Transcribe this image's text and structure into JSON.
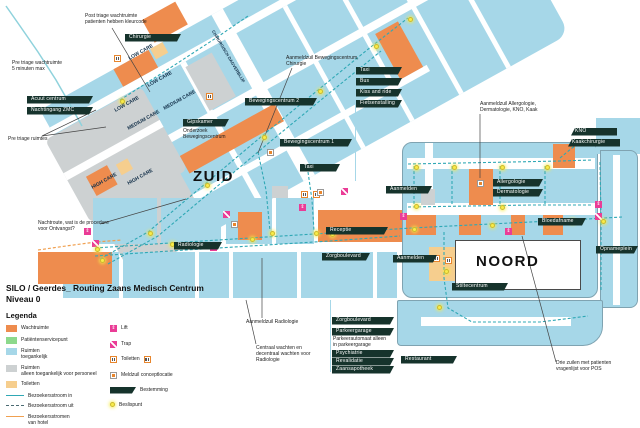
{
  "doc": {
    "title_line1": "SILO / Geerdes_ Routing Zaans Medisch Centrum",
    "title_line2": "Niveau 0",
    "legend_heading": "Legenda"
  },
  "colors": {
    "building_blue": "#A6D7E8",
    "waiting_orange": "#EE8C4E",
    "staff_gray": "#CDD1D2",
    "toilet_tan": "#F6CE8E",
    "service_green": "#8CD98C",
    "tag_dark": "#16332C",
    "route_teal": "#2FA8B5",
    "route_orange": "#F0A050",
    "decision_yellow": "#F7EC4A",
    "lift_pink": "#EA3C96"
  },
  "area_labels": [
    {
      "t": "ZUID",
      "x": 193,
      "y": 168,
      "s": 15,
      "big": true
    },
    {
      "t": "NOORD",
      "x": 476,
      "y": 253,
      "s": 15,
      "big": true
    },
    {
      "t": "LOW CARE",
      "x": 129,
      "y": 56,
      "r": -29
    },
    {
      "t": "LOW CARE",
      "x": 148,
      "y": 83,
      "r": -29
    },
    {
      "t": "LOW CARE",
      "x": 115,
      "y": 108,
      "r": -29
    },
    {
      "t": "MEDIUM CARE",
      "x": 164,
      "y": 106,
      "r": -29
    },
    {
      "t": "MEDIUM CARE",
      "x": 128,
      "y": 126,
      "r": -29
    },
    {
      "t": "HIGH CARE",
      "x": 92,
      "y": 185,
      "r": -29
    },
    {
      "t": "HIGH CARE",
      "x": 128,
      "y": 181,
      "r": -29
    },
    {
      "t": "CHIRURGISCH DAGVERBLIJF",
      "x": 213,
      "y": 28,
      "r": 59,
      "s": 4.2
    }
  ],
  "tags": [
    {
      "t": "Chirurgie",
      "x": 125,
      "y": 34,
      "w": 56
    },
    {
      "t": "Acuut centrum",
      "x": 27,
      "y": 96,
      "w": 66
    },
    {
      "t": "Nachtingang ZMC",
      "x": 27,
      "y": 107,
      "w": 66
    },
    {
      "t": "Gipskamer",
      "x": 183,
      "y": 119,
      "w": 46
    },
    {
      "t": "Bewegingscentrum 2",
      "x": 245,
      "y": 98,
      "w": 72
    },
    {
      "t": "Bewegingscentrum 1",
      "x": 280,
      "y": 139,
      "w": 72
    },
    {
      "t": "Taxi",
      "x": 300,
      "y": 164,
      "w": 40
    },
    {
      "t": "Taxi",
      "x": 356,
      "y": 67,
      "w": 46
    },
    {
      "t": "Bus",
      "x": 356,
      "y": 78,
      "w": 46
    },
    {
      "t": "Kiss and ride",
      "x": 356,
      "y": 89,
      "w": 46
    },
    {
      "t": "Fietsenstalling",
      "x": 356,
      "y": 100,
      "w": 46
    },
    {
      "t": "Aanmelden",
      "x": 386,
      "y": 186,
      "w": 46
    },
    {
      "t": "KNO",
      "x": 571,
      "y": 128,
      "w": 46,
      "dir": "l"
    },
    {
      "t": "Kaakchirurgie",
      "x": 568,
      "y": 139,
      "w": 52,
      "dir": "l"
    },
    {
      "t": "Allergologie",
      "x": 493,
      "y": 179,
      "w": 50
    },
    {
      "t": "Dermatologie",
      "x": 493,
      "y": 189,
      "w": 50
    },
    {
      "t": "Bloedafname",
      "x": 538,
      "y": 218,
      "w": 48
    },
    {
      "t": "Opnameplein",
      "x": 596,
      "y": 246,
      "w": 42
    },
    {
      "t": "Receptie",
      "x": 326,
      "y": 227,
      "w": 62
    },
    {
      "t": "Zorgboulevard",
      "x": 322,
      "y": 253,
      "w": 48
    },
    {
      "t": "Aanmelden",
      "x": 393,
      "y": 255,
      "w": 44
    },
    {
      "t": "Radiologie",
      "x": 174,
      "y": 242,
      "w": 48
    },
    {
      "t": "Stiltecentrum",
      "x": 452,
      "y": 283,
      "w": 56
    },
    {
      "t": "Zorgboulevard",
      "x": 332,
      "y": 317,
      "w": 62
    },
    {
      "t": "Parkeergarage",
      "x": 332,
      "y": 328,
      "w": 62
    },
    {
      "t": "Psychiatrie",
      "x": 332,
      "y": 350,
      "w": 62
    },
    {
      "t": "Revalidatie",
      "x": 332,
      "y": 358,
      "w": 62
    },
    {
      "t": "Zaansapotheek",
      "x": 332,
      "y": 366,
      "w": 62
    },
    {
      "t": "Restaurant",
      "x": 401,
      "y": 356,
      "w": 56
    }
  ],
  "callouts": [
    {
      "t": "Post triage wachtruimte\npatienten hebben kleurcode",
      "x": 85,
      "y": 13,
      "lines": [
        [
          112,
          28,
          150,
          92
        ]
      ]
    },
    {
      "t": "Pre triage wachtruimte\n5 minuten max",
      "x": 12,
      "y": 60
    },
    {
      "t": "Pre triage ruimtes",
      "x": 8,
      "y": 136,
      "lines": [
        [
          42,
          136,
          96,
          110
        ],
        [
          42,
          136,
          106,
          127
        ]
      ]
    },
    {
      "t": "Nachtroute, wat is de procedure\nvoor Ontvangst?",
      "x": 38,
      "y": 220,
      "lines": [
        [
          100,
          224,
          186,
          199
        ]
      ]
    },
    {
      "t": "Aanmeldzuil Bewegingscentrum,\nChirurgie",
      "x": 286,
      "y": 55,
      "lines": [
        [
          292,
          68,
          258,
          153
        ]
      ]
    },
    {
      "t": "Aanmeldzuil Allergologie,\nDermatologie, KNO, Kaak",
      "x": 480,
      "y": 101,
      "lines": [
        [
          480,
          114,
          480,
          178
        ]
      ]
    },
    {
      "t": "Onderzoek\nBewegingscentrum",
      "x": 183,
      "y": 128
    },
    {
      "t": "Aanmeldzuil Radiologie",
      "x": 246,
      "y": 319,
      "lines": [
        [
          262,
          318,
          262,
          258
        ]
      ]
    },
    {
      "t": "Centraal wachten en\ndecentraal wachten voor\nRadiologie",
      "x": 256,
      "y": 345,
      "lines": [
        [
          256,
          344,
          246,
          300
        ]
      ]
    },
    {
      "t": "Parkeerautomaat alleen\nin parkeergarage",
      "x": 333,
      "y": 336
    },
    {
      "t": "Drie zuilen met patienten\nvragenlijst voor POS",
      "x": 556,
      "y": 360,
      "lines": [
        [
          556,
          362,
          522,
          236
        ]
      ]
    }
  ],
  "legend": {
    "swatches": [
      {
        "color": "#EE8C4E",
        "label": "Wachtruimte"
      },
      {
        "color": "#8CD98C",
        "label": "Patiëntenservicepunt"
      },
      {
        "color": "#A6D7E8",
        "label": "Ruimten\ntoegankelijk"
      },
      {
        "color": "#CDD1D2",
        "label": "Ruimten\nalleen toegankelijk voor personeel"
      },
      {
        "color": "#F6CE8E",
        "label": "Toiletten"
      }
    ],
    "flows": [
      {
        "style": "solid",
        "color": "#2FA8B5",
        "label": "Bezoekersstroom in"
      },
      {
        "style": "dashed",
        "color": "#4a6a72",
        "label": "Bezoekersstroom uit"
      },
      {
        "style": "solid",
        "color": "#F0A050",
        "label": "Bezoekersstromen\nvan hotel"
      }
    ],
    "symbols": [
      {
        "type": "lift",
        "label": "Lift"
      },
      {
        "type": "trap",
        "label": "Trap"
      },
      {
        "type": "toilet",
        "label": "Toiletten",
        "extra": true
      },
      {
        "type": "meldzuil",
        "label": "Meldzuil conceptlocatie"
      },
      {
        "type": "tag",
        "label": "Bestemming"
      },
      {
        "type": "dot",
        "label": "Beslispunt"
      }
    ]
  },
  "icons": {
    "lifts": [
      [
        84,
        228
      ],
      [
        210,
        244
      ],
      [
        299,
        204
      ],
      [
        400,
        213
      ],
      [
        505,
        228
      ],
      [
        595,
        201
      ]
    ],
    "traps": [
      [
        92,
        240
      ],
      [
        223,
        211
      ],
      [
        341,
        188
      ],
      [
        595,
        213
      ]
    ],
    "toilets": [
      [
        114,
        55
      ],
      [
        206,
        93
      ],
      [
        301,
        191
      ],
      [
        313,
        191
      ],
      [
        433,
        255
      ],
      [
        445,
        257
      ]
    ],
    "meldzuils": [
      [
        231,
        221
      ],
      [
        267,
        149
      ],
      [
        477,
        180
      ],
      [
        317,
        189
      ]
    ]
  },
  "decision_points": [
    [
      100,
      258
    ],
    [
      148,
      231
    ],
    [
      205,
      183
    ],
    [
      262,
      135
    ],
    [
      318,
      89
    ],
    [
      374,
      44
    ],
    [
      408,
      17
    ],
    [
      120,
      99
    ],
    [
      95,
      247
    ],
    [
      170,
      242
    ],
    [
      250,
      237
    ],
    [
      330,
      232
    ],
    [
      412,
      227
    ],
    [
      490,
      223
    ],
    [
      570,
      219
    ],
    [
      270,
      231
    ],
    [
      314,
      231
    ],
    [
      414,
      165
    ],
    [
      452,
      165
    ],
    [
      500,
      165
    ],
    [
      545,
      165
    ],
    [
      414,
      204
    ],
    [
      500,
      205
    ],
    [
      601,
      219
    ],
    [
      444,
      269
    ],
    [
      437,
      305
    ]
  ],
  "routes": [
    {
      "c": "#2FA8B5",
      "w": 1.1,
      "d": "3 2",
      "p": [
        [
          100,
          259
        ],
        [
          148,
          232
        ],
        [
          205,
          184
        ],
        [
          262,
          136
        ],
        [
          318,
          90
        ],
        [
          372,
          46
        ],
        [
          408,
          18
        ]
      ]
    },
    {
      "c": "#2FA8B5",
      "w": 1.1,
      "d": "3 2",
      "p": [
        [
          108,
          264
        ],
        [
          158,
          236
        ],
        [
          214,
          189
        ],
        [
          271,
          141
        ],
        [
          327,
          95
        ],
        [
          381,
          51
        ]
      ]
    },
    {
      "c": "#2FA8B5",
      "w": 1.1,
      "d": "3 2",
      "p": [
        [
          120,
          100
        ],
        [
          170,
          68
        ],
        [
          216,
          38
        ],
        [
          248,
          16
        ]
      ]
    },
    {
      "c": "#2FA8B5",
      "w": 1.1,
      "d": "3 2",
      "p": [
        [
          95,
          248
        ],
        [
          170,
          243
        ],
        [
          250,
          238
        ],
        [
          330,
          233
        ],
        [
          412,
          228
        ],
        [
          490,
          224
        ],
        [
          570,
          220
        ],
        [
          622,
          217
        ]
      ]
    },
    {
      "c": "#2FA8B5",
      "w": 1.1,
      "d": "3 2",
      "p": [
        [
          95,
          256
        ],
        [
          170,
          251
        ],
        [
          250,
          246
        ],
        [
          330,
          241
        ],
        [
          400,
          236
        ]
      ]
    },
    {
      "c": "#2FA8B5",
      "w": 1.1,
      "d": "3 2",
      "p": [
        [
          258,
          152
        ],
        [
          266,
          190
        ],
        [
          270,
          231
        ]
      ]
    },
    {
      "c": "#2FA8B5",
      "w": 1.1,
      "d": "3 2",
      "p": [
        [
          308,
          172
        ],
        [
          312,
          200
        ],
        [
          314,
          231
        ]
      ]
    },
    {
      "c": "#2FA8B5",
      "w": 1.1,
      "d": "3 2",
      "p": [
        [
          408,
          164
        ],
        [
          460,
          163
        ],
        [
          512,
          162
        ],
        [
          560,
          161
        ],
        [
          592,
          160
        ]
      ]
    },
    {
      "c": "#2FA8B5",
      "w": 1.1,
      "d": "3 2",
      "p": [
        [
          414,
          166
        ],
        [
          414,
          204
        ]
      ]
    },
    {
      "c": "#2FA8B5",
      "w": 1.1,
      "d": "3 2",
      "p": [
        [
          452,
          166
        ],
        [
          452,
          204
        ]
      ]
    },
    {
      "c": "#2FA8B5",
      "w": 1.1,
      "d": "3 2",
      "p": [
        [
          500,
          166
        ],
        [
          500,
          204
        ]
      ]
    },
    {
      "c": "#2FA8B5",
      "w": 1.1,
      "d": "3 2",
      "p": [
        [
          545,
          166
        ],
        [
          545,
          204
        ]
      ]
    },
    {
      "c": "#2FA8B5",
      "w": 1.1,
      "d": "3 2",
      "p": [
        [
          408,
          207
        ],
        [
          470,
          206
        ],
        [
          530,
          205
        ],
        [
          592,
          205
        ]
      ]
    },
    {
      "c": "#2FA8B5",
      "w": 1.1,
      "d": "3 2",
      "p": [
        [
          600,
          162
        ],
        [
          601,
          220
        ],
        [
          601,
          290
        ]
      ]
    },
    {
      "c": "#2FA8B5",
      "w": 1.1,
      "d": "3 2",
      "p": [
        [
          444,
          232
        ],
        [
          444,
          278
        ],
        [
          448,
          308
        ],
        [
          472,
          322
        ],
        [
          540,
          322
        ],
        [
          588,
          316
        ]
      ]
    },
    {
      "c": "#2FA8B5",
      "w": 1.1,
      "d": "3 2",
      "p": [
        [
          560,
          158
        ],
        [
          572,
          148
        ],
        [
          585,
          140
        ]
      ]
    },
    {
      "c": "#8FD2DC",
      "w": 1.5,
      "d": "",
      "p": [
        [
          6,
          6
        ],
        [
          20,
          26
        ],
        [
          38,
          52
        ],
        [
          56,
          80
        ],
        [
          72,
          108
        ],
        [
          82,
          126
        ]
      ]
    },
    {
      "c": "#F0A050",
      "w": 1.2,
      "d": "3 2",
      "p": [
        [
          38,
          250
        ],
        [
          66,
          246
        ],
        [
          96,
          242
        ],
        [
          122,
          240
        ]
      ]
    }
  ]
}
